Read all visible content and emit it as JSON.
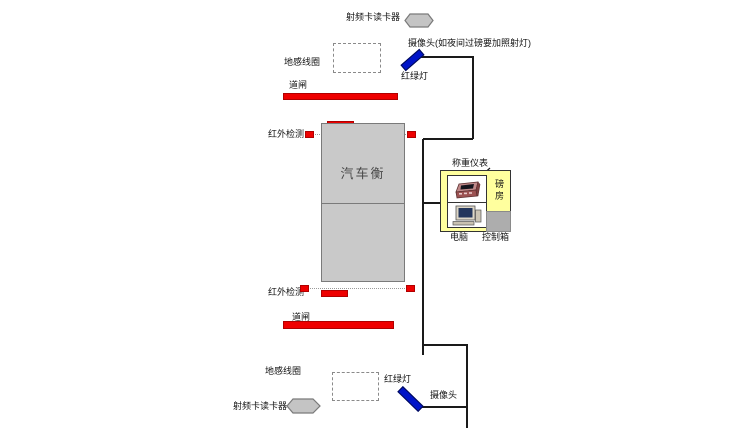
{
  "colors": {
    "red": "#ee0000",
    "blue": "#0014c8",
    "yellow_house": "#ffff9e",
    "scale_gray": "#c9c9c9",
    "hexagon_gray": "#c4c4c4",
    "line_black": "#1a1a1a"
  },
  "top_lane": {
    "rfid_reader": "射频卡读卡器",
    "camera_note": "摄像头(如夜间过磅要加照射灯)",
    "ground_coil": "地感线圈",
    "traffic_light": "红绿灯",
    "barrier": "道闸",
    "infrared": "红外检测"
  },
  "scale": {
    "label": "汽车衡"
  },
  "bottom_lane": {
    "infrared": "红外检测",
    "barrier": "道闸",
    "ground_coil": "地感线圈",
    "traffic_light": "红绿灯",
    "camera": "摄像头",
    "rfid_reader": "射频卡读卡器"
  },
  "station": {
    "weighing_indicator": "称重仪表",
    "scale_house": "磅房",
    "computer": "电脑",
    "control_box": "控制箱"
  }
}
